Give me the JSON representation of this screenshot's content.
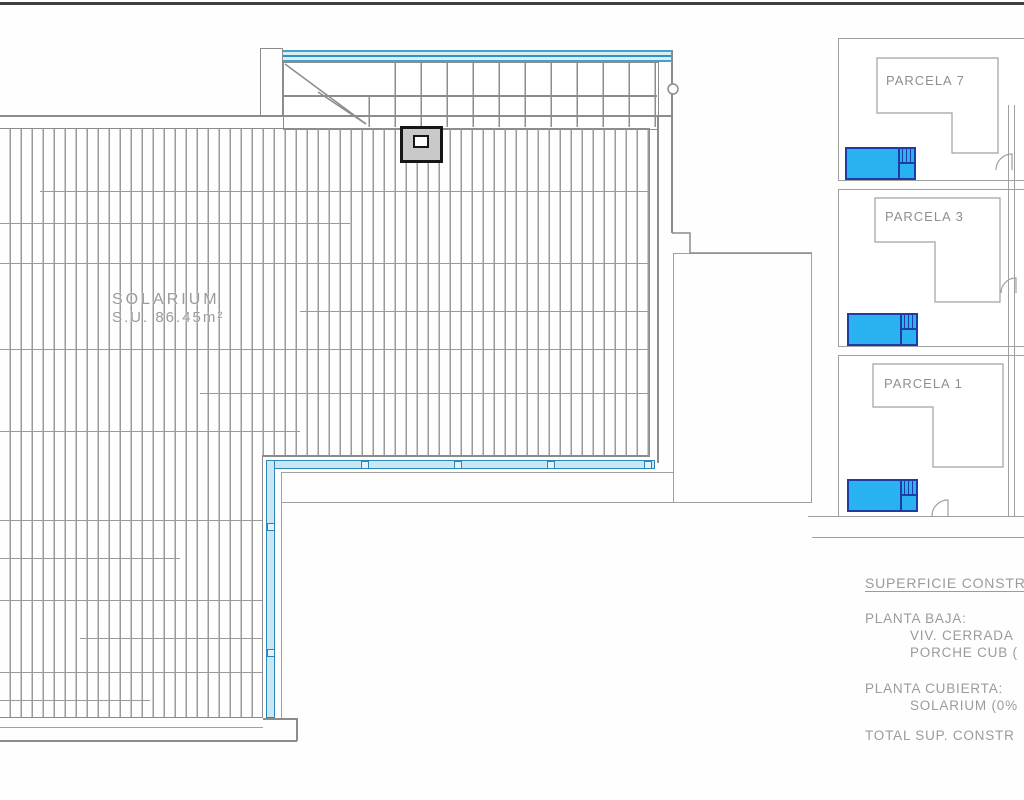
{
  "plan": {
    "solarium_label": "SOLARIUM",
    "solarium_area": "S.U. 86.45m²"
  },
  "parcels": [
    {
      "label": "PARCELA 7"
    },
    {
      "label": "PARCELA 3"
    },
    {
      "label": "PARCELA 1"
    }
  ],
  "summary": {
    "rows": [
      {
        "text": "SUPERFICIE CONSTR"
      },
      {
        "text": "PLANTA BAJA:"
      },
      {
        "text": "VIV. CERRADA"
      },
      {
        "text": "PORCHE CUB ("
      },
      {
        "text": "PLANTA CUBIERTA:"
      },
      {
        "text": "SOLARIUM (0%"
      },
      {
        "text": "TOTAL SUP. CONSTR"
      }
    ]
  },
  "colors": {
    "line": "#8c8c8c",
    "line_light": "#a0a0a0",
    "text": "#9b9b9b",
    "top_rule": "#3f3f3f",
    "hatch_line": "#9a9a9a",
    "rail_fill": "#c7e7f4",
    "rail_stroke": "#2e86b6",
    "band_fill": "#d8eef6",
    "band_stroke": "#49a0c8",
    "band_mid": "#2d93bf",
    "pool_fill": "#29b1f0",
    "pool_stroke": "#1d3ca6",
    "sky_fill": "#c9c9c9",
    "sky_stroke": "#161616"
  }
}
